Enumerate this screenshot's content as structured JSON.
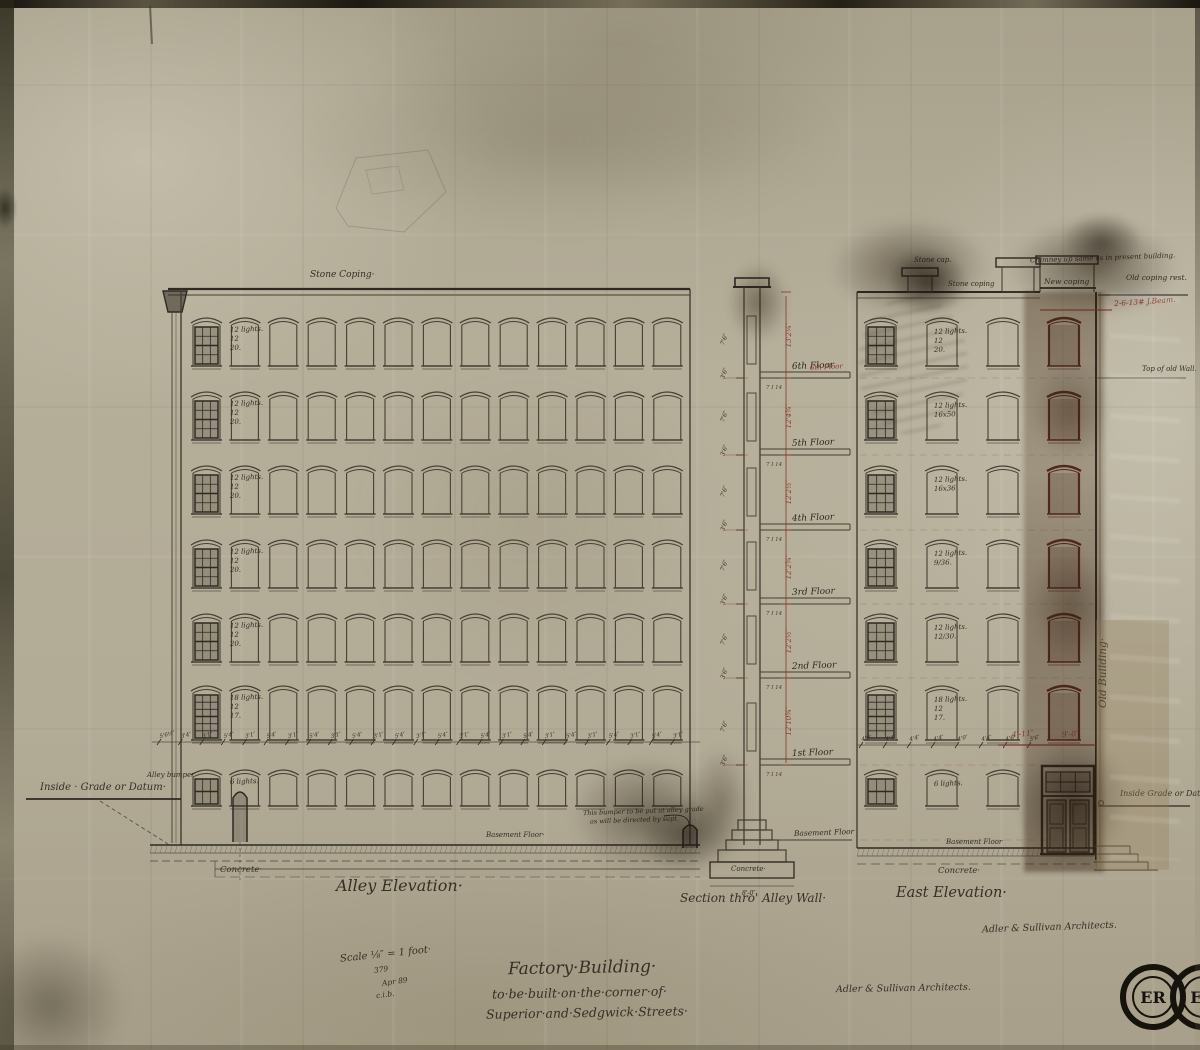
{
  "sheet": {
    "title": [
      "Factory·Building·",
      "to·be·built·on·the·corner·of·",
      "Superior·and·Sedgwick·Streets·"
    ],
    "scale_block": [
      "Scale ⅛″ = 1 foot·",
      "379",
      "Apr 89",
      "c.i.b."
    ],
    "signature_center": "Adler & Sullivan Architects.",
    "signature_east": "Adler & Sullivan Architects.",
    "stamp_text": "ER",
    "ink": "#453e33",
    "red_ink": "#8a3a30"
  },
  "alley": {
    "label": "Alley Elevation·",
    "coping_label": "Stone Coping·",
    "datum_label": "Inside · Grade or Datum·",
    "bumper_label": "Alley bumper",
    "bumper_note": [
      "This bumper to be put at alley grade",
      "as will be directed by supt."
    ],
    "concrete_label": "Concrete·",
    "basement_label": "Basement Floor·",
    "row_labels": [
      [
        "12 lights.",
        "12",
        "20."
      ],
      [
        "12 lights.",
        "12",
        "20."
      ],
      [
        "12 lights.",
        "12",
        "20."
      ],
      [
        "12 lights.",
        "12",
        "20."
      ],
      [
        "12 lights.",
        "12",
        "20."
      ],
      [
        "18 lights.",
        "12",
        "17."
      ],
      [
        "6 lights."
      ]
    ],
    "dim_labels": [
      "5'6½″",
      "3'4″",
      "3'1″",
      "5'4″",
      "3'1″",
      "5'4″",
      "3'1″",
      "5'4″",
      "3'1″",
      "5'4″",
      "3'1″",
      "5'4″",
      "3'1″",
      "5'4″",
      "3'1″",
      "5'4″",
      "3'1″",
      "5'4″",
      "3'1″",
      "5'4″",
      "3'1″",
      "5'4″",
      "3'1″",
      "5'4″",
      "3'1″"
    ]
  },
  "section": {
    "label": "Section thro' Alley Wall·",
    "floors": [
      "6th Floor",
      "5th Floor",
      "4th Floor",
      "3rd Floor",
      "2nd Floor",
      "1st Floor"
    ],
    "basement_label": "Basement Floor",
    "beam_label": "7 I 14",
    "concrete_label": "Concrete·",
    "footing_dim": "8'-0″",
    "red_floor_note": "6th Floor",
    "left_ticks": [
      "7'6″",
      "3'6″",
      "7'6″",
      "3'6″",
      "7'6″",
      "3'6″",
      "7'6″",
      "3'6″",
      "7'6″",
      "3'6″",
      "7'6″",
      "3'6″"
    ],
    "red_heights": [
      "13'2¼″",
      "12'4¾″",
      "12'2½″",
      "12'2¾″",
      "12'2½″",
      "12'10¾″"
    ]
  },
  "east": {
    "label": "East Elevation·",
    "stone_cap_label": "Stone cap.",
    "stone_coping_label": "Stone coping",
    "chimney_note": "Chimney up same as in present building.",
    "new_coping_label": "New coping",
    "old_coping_label": "Old coping rest.",
    "jbeam_note": "2-6-13# J.Beam.",
    "top_old_wall_label": "Top of old Wall.",
    "old_building_label": "Old Building·",
    "datum_label": "Inside Grade or Datum",
    "basement_label": "Basement Floor",
    "concrete_label": "Concrete·",
    "row_labels": [
      [
        "12 lights.",
        "12",
        "20."
      ],
      [
        "12 lights.",
        "16x50."
      ],
      [
        "12 lights.",
        "16x36."
      ],
      [
        "12 lights.",
        "9/36."
      ],
      [
        "12 lights.",
        "12/30."
      ],
      [
        "18 lights.",
        "12",
        "17."
      ],
      [
        "6 lights."
      ]
    ],
    "dim_labels": [
      "4'0″",
      "4'4″",
      "4'4″",
      "4'4″",
      "4'0″",
      "4'4″",
      "4'6″",
      "3'6″"
    ],
    "red_dims": [
      "4'-11″",
      "9'-0″"
    ]
  }
}
